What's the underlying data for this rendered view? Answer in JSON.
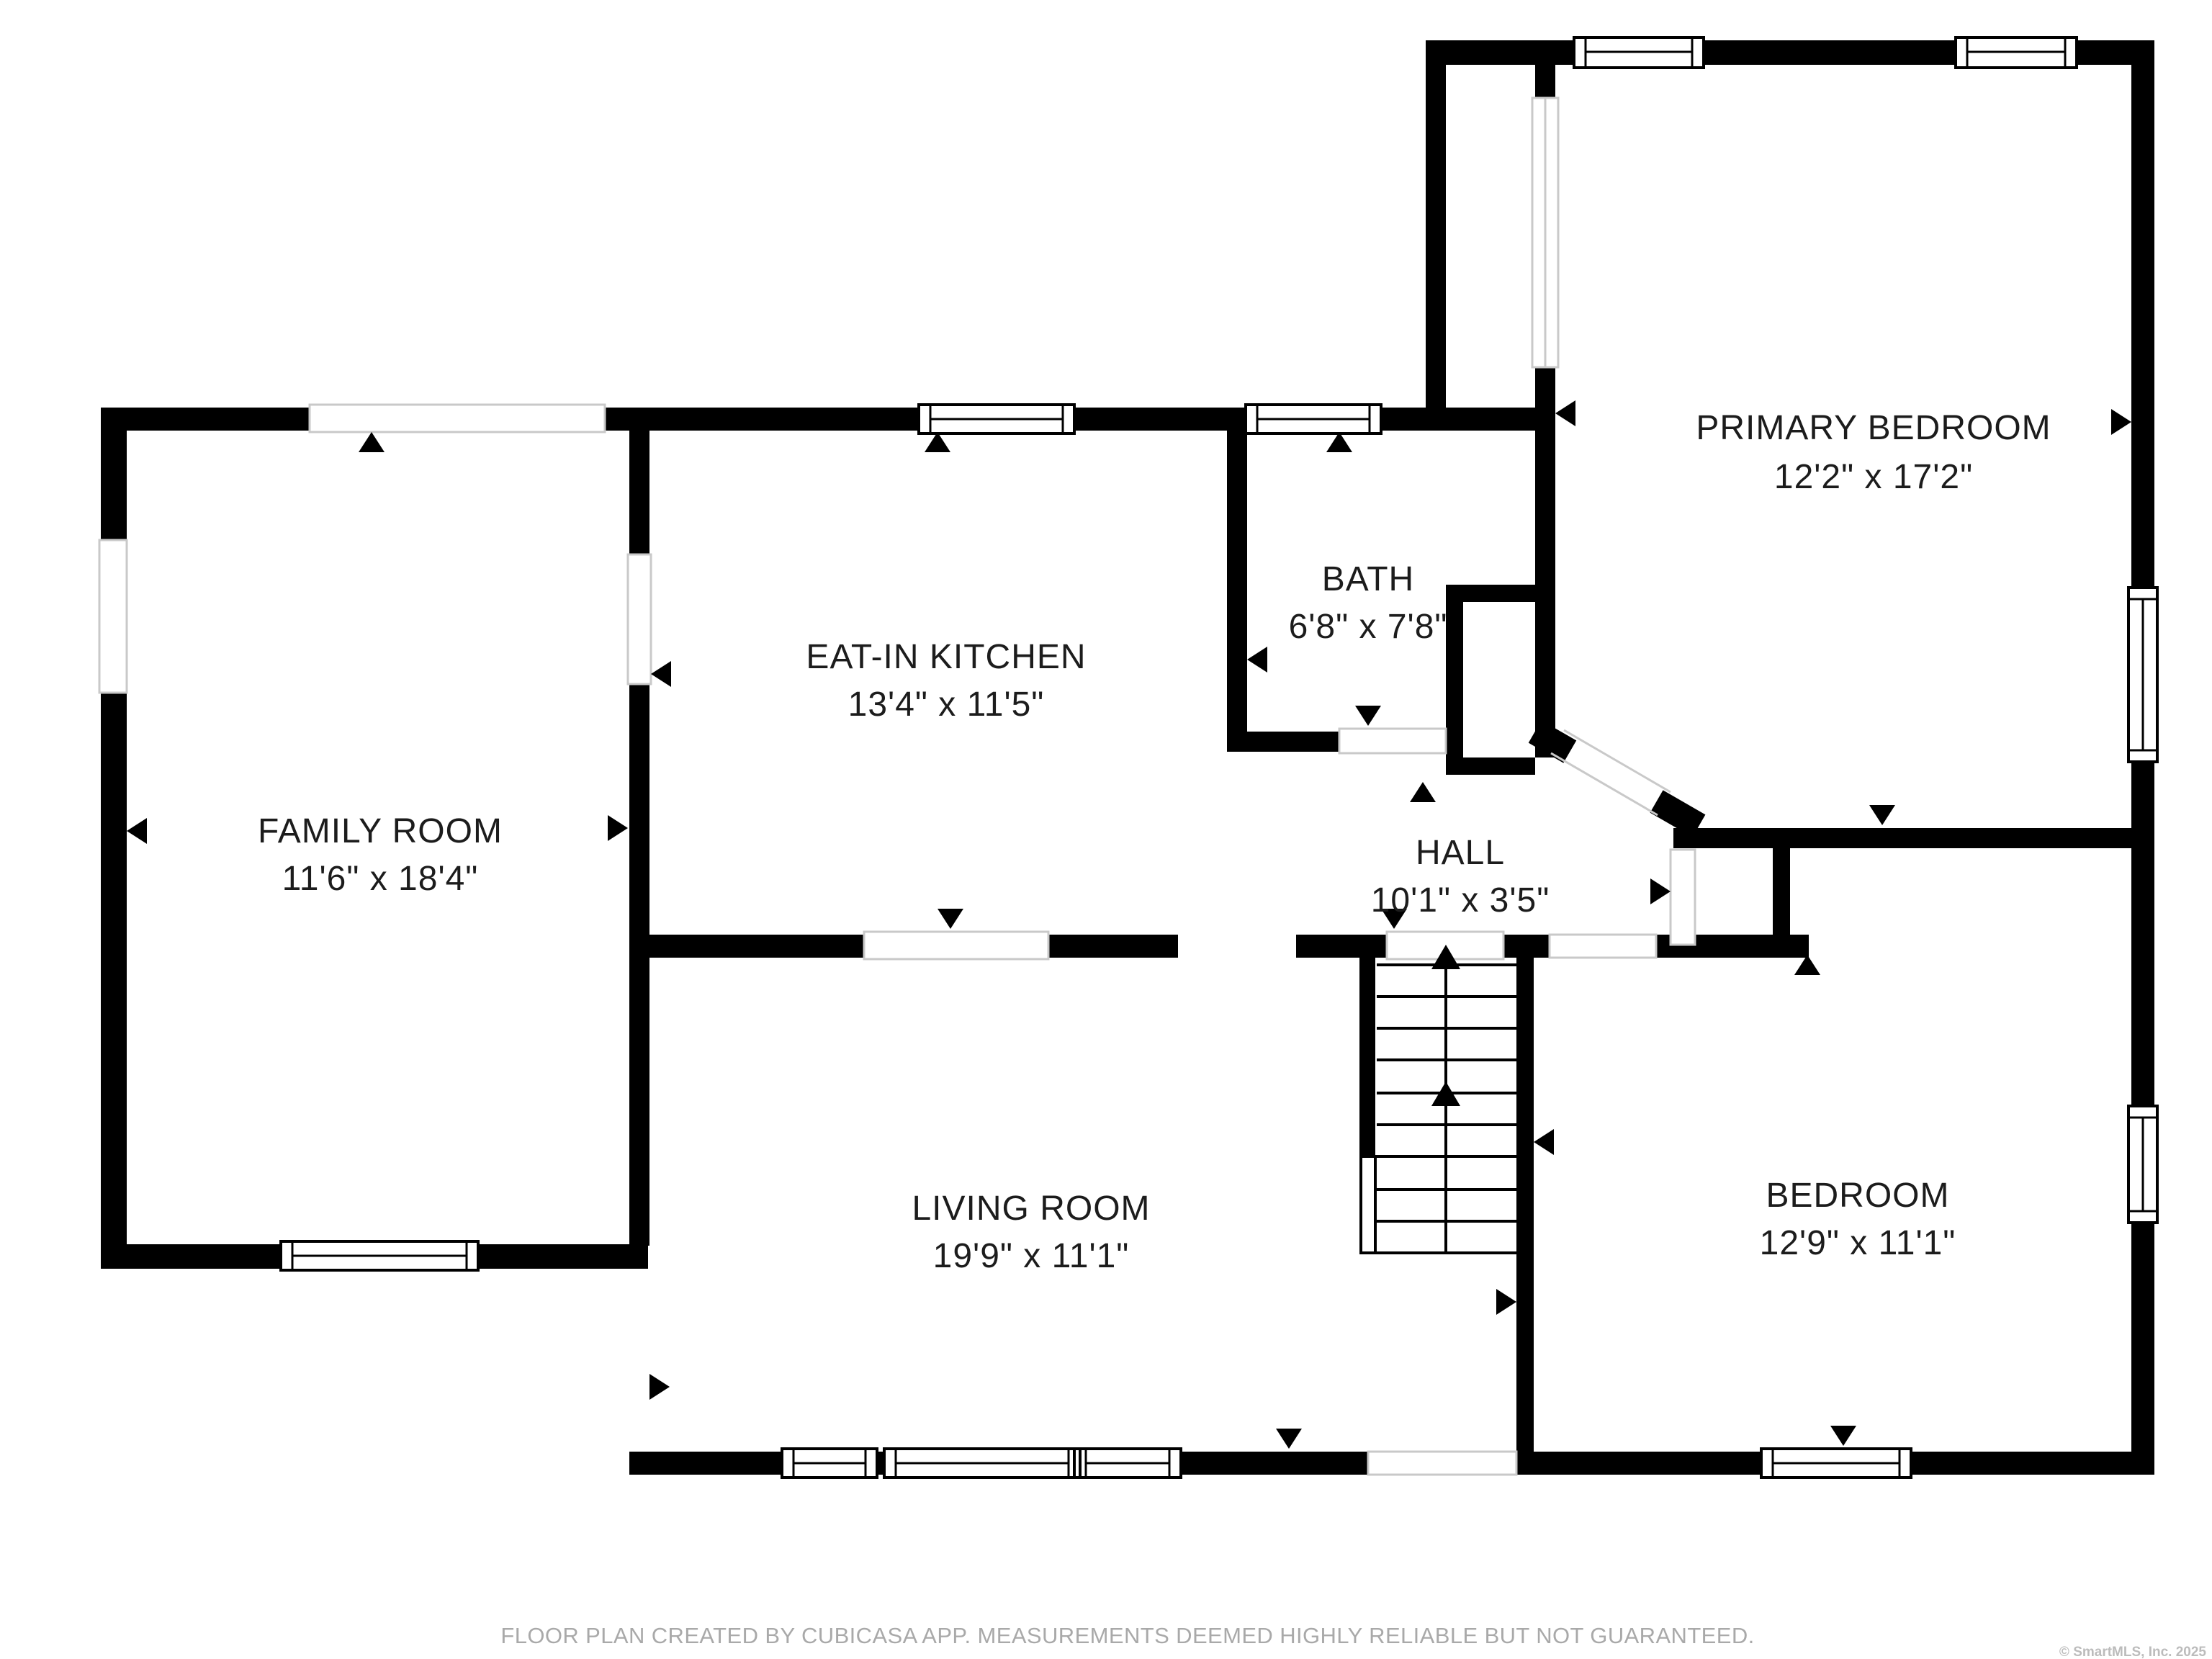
{
  "floor_plan": {
    "rooms": [
      {
        "name": "FAMILY ROOM",
        "dims": "11'6\" x 18'4\""
      },
      {
        "name": "EAT-IN KITCHEN",
        "dims": "13'4\" x 11'5\""
      },
      {
        "name": "BATH",
        "dims": "6'8\" x 7'8\""
      },
      {
        "name": "PRIMARY BEDROOM",
        "dims": "12'2\" x 17'2\""
      },
      {
        "name": "HALL",
        "dims": "10'1\" x 3'5\""
      },
      {
        "name": "LIVING ROOM",
        "dims": "19'9\" x 11'1\""
      },
      {
        "name": "BEDROOM",
        "dims": "12'9\" x 11'1\""
      }
    ],
    "colors": {
      "wall": "#000000",
      "opening_outline": "#c9c9c9",
      "label_text": "#1c1c1c",
      "footer_text": "#a9a9a9",
      "copyright_text": "#bcbcbc",
      "background": "#ffffff"
    }
  },
  "footer": {
    "disclaimer": "FLOOR PLAN CREATED BY CUBICASA APP. MEASUREMENTS DEEMED HIGHLY RELIABLE BUT NOT GUARANTEED."
  },
  "copyright": {
    "text": "© SmartMLS, Inc.  2025"
  }
}
